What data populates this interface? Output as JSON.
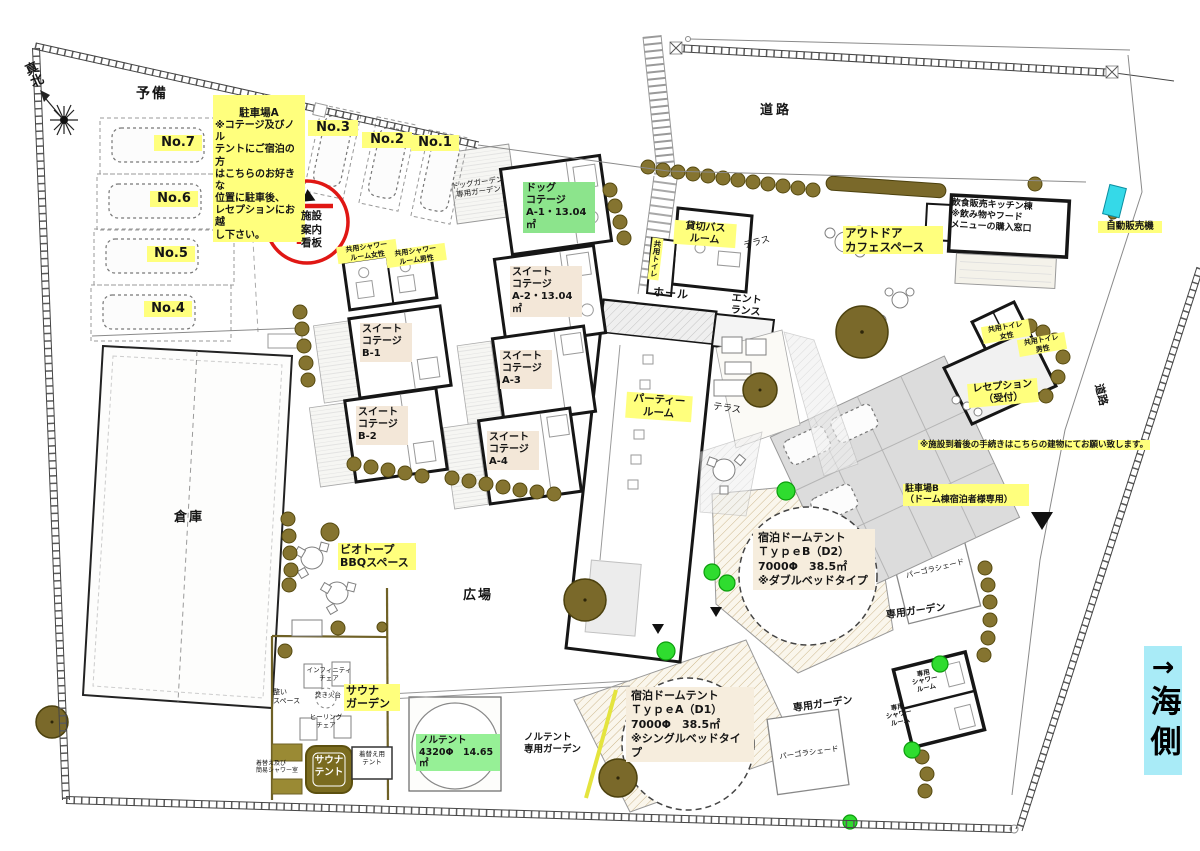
{
  "colors": {
    "highlight_yellow": "#ffff7d",
    "label_green": "#8ce48c",
    "label_mint": "#96f096",
    "label_beige": "#f3e7d8",
    "sign_red": "#e01714",
    "vending_cyan": "#35d9e8",
    "sea_cyan": "#a9ebf7",
    "tree_brown": "#7a692a"
  },
  "compass": {
    "north_label": "真北"
  },
  "roads": {
    "top": "道路",
    "east": "道路"
  },
  "sea": {
    "arrow": "→",
    "label": "海側"
  },
  "parking_a": {
    "reserve": "予備",
    "note_title": "駐車場A",
    "note_body": "※コテージ及びノル\nテントにご宿泊の方\nはこちらのお好きな\n位置に駐車後、\nレセプションにお越\nし下さい。",
    "spaces": [
      "No.7",
      "No.6",
      "No.5",
      "No.4",
      "No.3",
      "No.2",
      "No.1"
    ]
  },
  "sign_board": {
    "label": "施設\n案内\n看板"
  },
  "shower_rooms": {
    "female": "共用シャワー\nルーム女性",
    "male": "共用シャワー\nルーム男性"
  },
  "dog_garden": {
    "label": "ドッグガーデン\n専用ガーデン"
  },
  "cottages": {
    "a1": "ドッグ\nコテージ\nA-1・13.04㎡",
    "a2": "スイート\nコテージ\nA-2・13.04㎡",
    "a3": "スイート\nコテージ\nA-3",
    "a4": "スイート\nコテージ\nA-4",
    "b1": "スイート\nコテージ\nB-1",
    "b2": "スイート\nコテージ\nB-2"
  },
  "main_building": {
    "hall": "ホール",
    "entrance": "エント\nランス",
    "terrace_upper": "テラス",
    "terrace_lower": "テラス",
    "party_room": "パーティー\nルーム",
    "private_bath": "貸切バス\nルーム",
    "shared_toilet": "共用トイレ"
  },
  "cafe": {
    "space": "アウトドア\nカフェスペース",
    "kitchen": "飲食販売キッチン棟\n※飲み物やフード\nメニューの購入窓口",
    "vending": "自動販売機"
  },
  "reception": {
    "label": "レセプション\n（受付）",
    "toilet_female": "共用トイレ\n女性",
    "toilet_male": "共用トイレ\n男性",
    "notice": "※施設到着後の手続きはこちらの建物にてお願い致します。"
  },
  "parking_b": {
    "label": "駐車場B\n（ドーム棟宿泊者様専用）"
  },
  "domes": {
    "type_b": "宿泊ドームテント\nＴｙｐｅB（D2）\n7000Φ　38.5㎡\n※ダブルベッドタイプ",
    "type_a": "宿泊ドームテント\nＴｙｐｅA（D1）\n7000Φ　38.5㎡\n※シングルベッドタイプ",
    "pergola": "パーゴラシェード",
    "private_garden": "専用ガーデン",
    "private_shower": "専用\nシャワー\nルーム"
  },
  "plaza": {
    "label": "広場"
  },
  "bbq": {
    "label": "ビオトープ\nBBQスペース"
  },
  "warehouse": {
    "label": "倉庫"
  },
  "sauna": {
    "garden": "サウナ\nガーデン",
    "infinity_chair": "インフィニティ\nチェア",
    "rest_space": "整い\nスペース",
    "fire_pit": "焚き火台",
    "healing_chair": "ヒーリング\nチェア",
    "tent": "サウナ\nテント",
    "changing_shower": "着替え及び\n簡易シャワー室",
    "changing_tent": "着替え用\nテント"
  },
  "nortent": {
    "label": "ノルテント\n4320Φ　14.65㎡",
    "garden": "ノルテント\n専用ガーデン"
  }
}
